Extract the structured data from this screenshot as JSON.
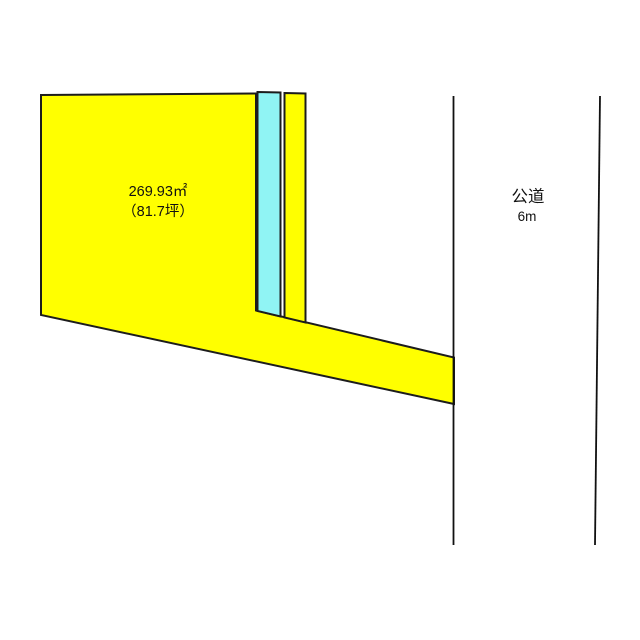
{
  "diagram": {
    "background": "#ffffff",
    "outline_color": "#1c1c1c",
    "parcel": {
      "area_label": "269.93㎡",
      "tsubo_label": "（81.7坪）",
      "fill": "#ffff00",
      "points": "41,95 256,93.5 256,310.5 454,357.5 454,404 41,315"
    },
    "canal_strip": {
      "fill": "#90f4f4",
      "points": "257.5,92 280.5,92.5 280.5,316.5 257.5,311"
    },
    "side_strip": {
      "fill": "#ffff00",
      "points": "284.5,93 305.5,93.5 305.5,322.5 284.5,317.5"
    },
    "road": {
      "name_label": "公道",
      "width_label": "6m",
      "left_line_points": "453.5,96 453.5,545",
      "right_line_points": "600,96 595,545",
      "line_color": "#111111"
    }
  }
}
